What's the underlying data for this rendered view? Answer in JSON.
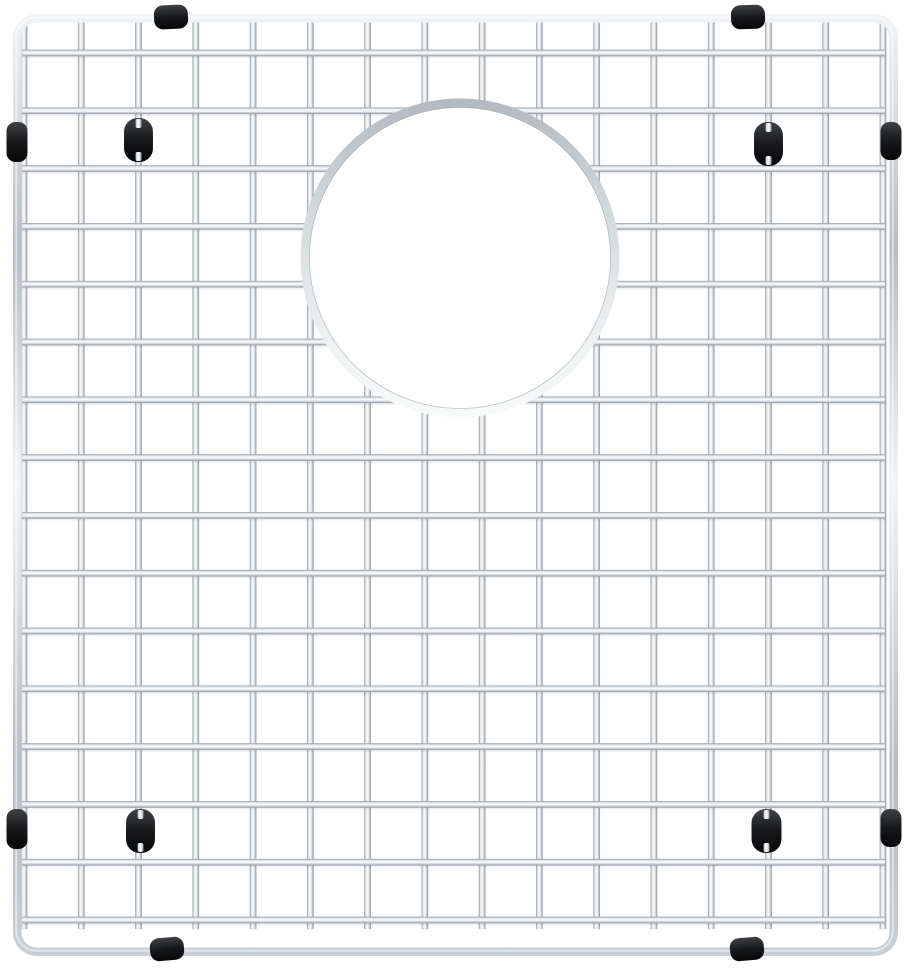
{
  "scene": {
    "description": "Stainless steel wire sink bottom grid with a circular drain opening, four black rubber feet and eight black rubber edge bumpers, photographed on a plain white background",
    "background_color": "#ffffff",
    "canvas": {
      "width": 914,
      "height": 971
    }
  },
  "colors": {
    "background": "#ffffff",
    "wire_edge_dark": "#8b9298",
    "wire_mid": "#d9dee2",
    "wire_highlight": "#fafbfc",
    "wire_shade": "#b7bdc3",
    "frame_light": "#f2f4f6",
    "frame_dark": "#b6bcc2",
    "ring_top": "#b3b9bf",
    "ring_bottom": "#f8fafa",
    "ring_inner_edge": "#868d93",
    "rubber_highlight": "#3f4144",
    "rubber_mid": "#17181a",
    "rubber_dark": "#070708",
    "weld_shadow": "#2a2f33"
  },
  "frame": {
    "x": 13,
    "y": 14,
    "width": 885,
    "height": 942,
    "corner_radius": 24,
    "tube_thickness": 8.5
  },
  "grid": {
    "wire_thickness": 6.5,
    "vertical_wires": {
      "count": 16,
      "first_x": 24,
      "last_x": 883,
      "top_y": 22,
      "bottom_y": 929
    },
    "horizontal_wires": {
      "count": 16,
      "first_y": 53,
      "last_y": 920,
      "left_x": 22,
      "right_x": 885
    }
  },
  "drain_opening": {
    "cx": 460,
    "cy": 258,
    "outer_radius": 159.5,
    "ring_thickness": 9
  },
  "feet": [
    {
      "position": "top-left",
      "cx": 138.5,
      "cy": 140,
      "width": 29,
      "height": 44
    },
    {
      "position": "top-right",
      "cx": 768.5,
      "cy": 144,
      "width": 29,
      "height": 44
    },
    {
      "position": "bottom-left",
      "cx": 140.5,
      "cy": 831,
      "width": 29,
      "height": 44
    },
    {
      "position": "bottom-right",
      "cx": 766.5,
      "cy": 831,
      "width": 30,
      "height": 44
    }
  ],
  "bumpers": [
    {
      "edge": "top",
      "index": 1,
      "cx": 171,
      "cy": 17,
      "width": 34,
      "height": 24,
      "angle": -3
    },
    {
      "edge": "top",
      "index": 2,
      "cx": 748,
      "cy": 17,
      "width": 34,
      "height": 24,
      "angle": -2
    },
    {
      "edge": "left",
      "index": 1,
      "cx": 17,
      "cy": 142,
      "width": 21,
      "height": 40,
      "angle": 0
    },
    {
      "edge": "left",
      "index": 2,
      "cx": 17,
      "cy": 829,
      "width": 21,
      "height": 40,
      "angle": 0
    },
    {
      "edge": "right",
      "index": 1,
      "cx": 891,
      "cy": 141,
      "width": 21,
      "height": 38,
      "angle": 0
    },
    {
      "edge": "right",
      "index": 2,
      "cx": 891,
      "cy": 828,
      "width": 21,
      "height": 38,
      "angle": 0
    },
    {
      "edge": "bottom",
      "index": 1,
      "cx": 167,
      "cy": 949,
      "width": 34,
      "height": 23,
      "angle": -5
    },
    {
      "edge": "bottom",
      "index": 2,
      "cx": 747,
      "cy": 949,
      "width": 34,
      "height": 23,
      "angle": -5
    }
  ]
}
